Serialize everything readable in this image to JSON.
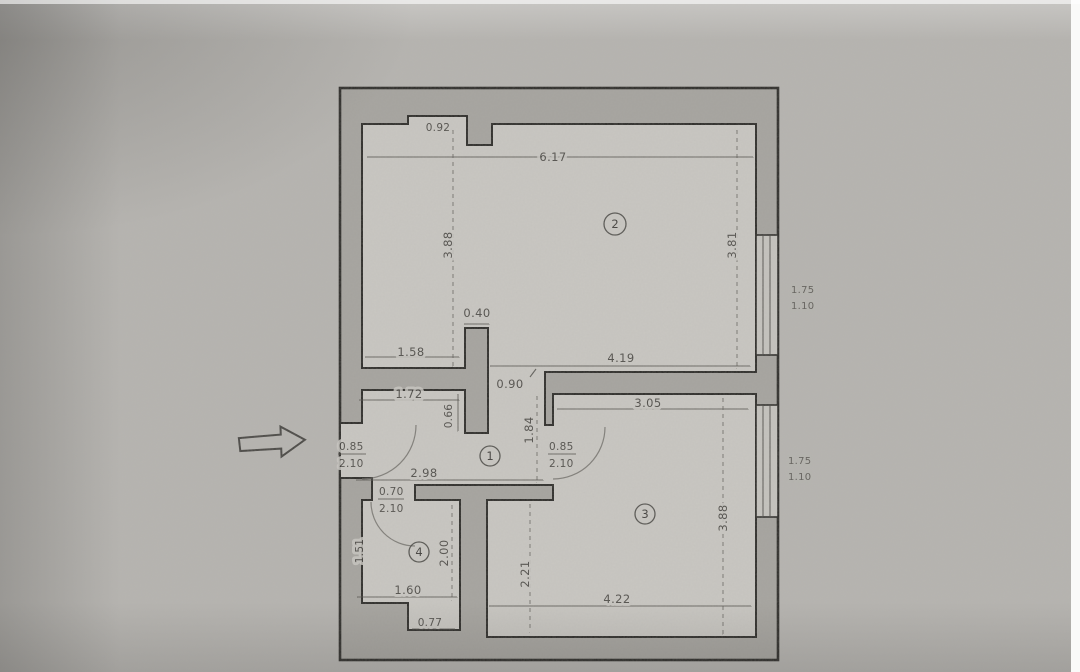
{
  "colors": {
    "paper": "#b6b4b0",
    "floor": "#c9c7c2",
    "wall_fill": "#a5a39e",
    "outline": "#2b2a27",
    "dim_text": "#3a3834"
  },
  "rooms": [
    {
      "label": "1"
    },
    {
      "label": "2"
    },
    {
      "label": "3"
    },
    {
      "label": "4"
    }
  ],
  "dimensions": {
    "niche_width": "0.92",
    "room2_width": "6.17",
    "room2_height_left": "3.88",
    "room2_height_right": "3.81",
    "pillar_width": "0.40",
    "room2_bottom_left_width": "1.58",
    "room2_bottom_right_width": "4.19",
    "room2_opening_width": "0.90",
    "hall_top_width": "1.72",
    "room3_top_width": "3.05",
    "pillar_depth": "0.66",
    "hall_depth": "1.84",
    "hall_width": "2.98",
    "room4_left_height": "1.51",
    "room4_mid_height": "2.00",
    "room3_left_height": "2.21",
    "room3_right_height": "3.88",
    "room4_width": "1.60",
    "room3_width": "4.22",
    "recess_width": "0.77"
  },
  "doors": {
    "entry": {
      "width": "0.85",
      "height": "2.10"
    },
    "room3": {
      "width": "0.85",
      "height": "2.10"
    },
    "room4": {
      "width": "0.70",
      "height": "2.10"
    }
  },
  "windows": {
    "upper": {
      "width": "1.75",
      "height": "1.10"
    },
    "lower": {
      "width": "1.75",
      "height": "1.10"
    }
  }
}
